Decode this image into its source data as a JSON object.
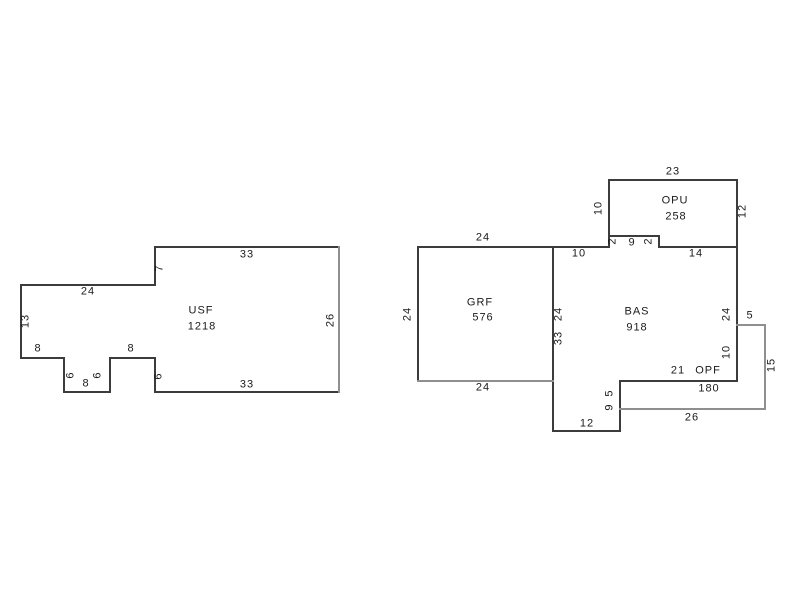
{
  "sketch": {
    "background": "#ffffff",
    "wall_color": "#3c3c3c",
    "porch_wall_color": "#8f8f8f",
    "text_color": "#1a1a1a",
    "areas": [
      {
        "code": "USF",
        "sqft": "1218",
        "code_x": 201,
        "code_y": 311,
        "sqft_x": 202,
        "sqft_y": 327
      },
      {
        "code": "GRF",
        "sqft": "576",
        "code_x": 480,
        "code_y": 303,
        "sqft_x": 483,
        "sqft_y": 318
      },
      {
        "code": "BAS",
        "sqft": "918",
        "code_x": 637,
        "code_y": 312,
        "sqft_x": 637,
        "sqft_y": 328
      },
      {
        "code": "OPU",
        "sqft": "258",
        "code_x": 675,
        "code_y": 201,
        "sqft_x": 676,
        "sqft_y": 217
      },
      {
        "code": "OPF",
        "sqft": "180",
        "code_x": 708,
        "code_y": 371,
        "sqft_x": 709,
        "sqft_y": 389
      }
    ],
    "dimensions": [
      {
        "value": "33",
        "x": 247,
        "y": 255,
        "rotated": false
      },
      {
        "value": "7",
        "x": 160,
        "y": 268,
        "rotated": true
      },
      {
        "value": "24",
        "x": 88,
        "y": 292,
        "rotated": false
      },
      {
        "value": "13",
        "x": 26,
        "y": 321,
        "rotated": true
      },
      {
        "value": "8",
        "x": 38,
        "y": 349,
        "rotated": false
      },
      {
        "value": "8",
        "x": 131,
        "y": 349,
        "rotated": false
      },
      {
        "value": "6",
        "x": 71,
        "y": 375,
        "rotated": true
      },
      {
        "value": "6",
        "x": 98,
        "y": 375,
        "rotated": true
      },
      {
        "value": "8",
        "x": 86,
        "y": 384,
        "rotated": false
      },
      {
        "value": "6",
        "x": 159,
        "y": 376,
        "rotated": true
      },
      {
        "value": "33",
        "x": 247,
        "y": 385,
        "rotated": false
      },
      {
        "value": "26",
        "x": 331,
        "y": 320,
        "rotated": true
      },
      {
        "value": "24",
        "x": 483,
        "y": 238,
        "rotated": false
      },
      {
        "value": "24",
        "x": 408,
        "y": 314,
        "rotated": true
      },
      {
        "value": "24",
        "x": 483,
        "y": 388,
        "rotated": false
      },
      {
        "value": "24",
        "x": 559,
        "y": 314,
        "rotated": true
      },
      {
        "value": "33",
        "x": 559,
        "y": 338,
        "rotated": true
      },
      {
        "value": "10",
        "x": 579,
        "y": 254,
        "rotated": false
      },
      {
        "value": "2",
        "x": 613,
        "y": 241,
        "rotated": true
      },
      {
        "value": "9",
        "x": 632,
        "y": 243,
        "rotated": false
      },
      {
        "value": "2",
        "x": 649,
        "y": 241,
        "rotated": true
      },
      {
        "value": "14",
        "x": 696,
        "y": 254,
        "rotated": false
      },
      {
        "value": "23",
        "x": 673,
        "y": 172,
        "rotated": false
      },
      {
        "value": "10",
        "x": 599,
        "y": 208,
        "rotated": true
      },
      {
        "value": "12",
        "x": 743,
        "y": 211,
        "rotated": true
      },
      {
        "value": "24",
        "x": 727,
        "y": 314,
        "rotated": true
      },
      {
        "value": "5",
        "x": 750,
        "y": 316,
        "rotated": false
      },
      {
        "value": "10",
        "x": 727,
        "y": 352,
        "rotated": true
      },
      {
        "value": "15",
        "x": 772,
        "y": 365,
        "rotated": true
      },
      {
        "value": "21",
        "x": 678,
        "y": 371,
        "rotated": false
      },
      {
        "value": "26",
        "x": 692,
        "y": 418,
        "rotated": false
      },
      {
        "value": "5",
        "x": 610,
        "y": 393,
        "rotated": true
      },
      {
        "value": "9",
        "x": 610,
        "y": 407,
        "rotated": true
      },
      {
        "value": "12",
        "x": 587,
        "y": 424,
        "rotated": false
      }
    ]
  }
}
